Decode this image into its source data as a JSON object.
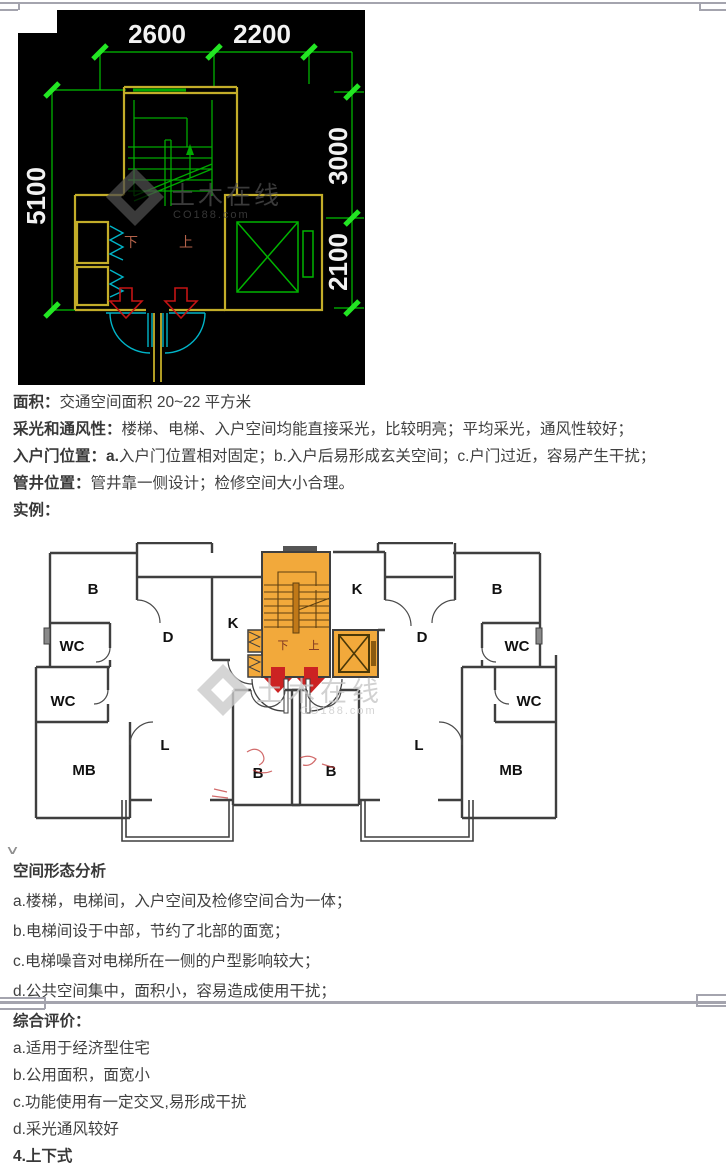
{
  "document": {
    "intro": {
      "paragraphs": [
        {
          "label": "面积：",
          "text": "交通空间面积 20~22 平方米"
        },
        {
          "label": "采光和通风性：",
          "text": "楼梯、电梯、入户空间均能直接采光，比较明亮；平均采光，通风性较好；"
        },
        {
          "label": "入户门位置：a.",
          "text": "入户门位置相对固定；b.入户后易形成玄关空间；c.户门过近，容易产生干扰；"
        },
        {
          "label": "管井位置：",
          "text": "管井靠一侧设计；检修空间大小合理。"
        },
        {
          "label": "实例：",
          "text": ""
        }
      ]
    },
    "analysis": {
      "heading": "空间形态分析",
      "items": [
        "a.楼梯，电梯间，入户空间及检修空间合为一体；",
        "b.电梯间设于中部，节约了北部的面宽；",
        "c.电梯噪音对电梯所在一侧的户型影响较大；",
        "d.公共空间集中，面积小，容易造成使用干扰；"
      ]
    },
    "evaluation": {
      "heading": "综合评价：",
      "items": [
        "a.适用于经济型住宅",
        "b.公用面积，面宽小",
        "c.功能使用有一定交叉,易形成干扰",
        "d.采光通风较好"
      ],
      "next_section": "4.上下式"
    },
    "page_mark": "∨"
  },
  "cad_drawing": {
    "dimensions": {
      "top": [
        "2600",
        "2200"
      ],
      "left": [
        "5100"
      ],
      "right": [
        "3000",
        "2100"
      ]
    },
    "stair_labels": {
      "down": "下",
      "up": "上"
    },
    "watermark": {
      "brand": "土木在线",
      "site": "CO188.com"
    },
    "colors": {
      "background": "#000000",
      "dimension_line": "#00c000",
      "tick_green": "#23e623",
      "wall_yellow": "#c3ad29",
      "stair_green": "#00a800",
      "door_cyan": "#00b4c8",
      "arrow_red": "#c41414",
      "dim_text": "#f2f2f2"
    }
  },
  "floor_plan": {
    "rooms": [
      {
        "text": "B"
      },
      {
        "text": "WC"
      },
      {
        "text": "D"
      },
      {
        "text": "K"
      },
      {
        "text": "K"
      },
      {
        "text": "B"
      },
      {
        "text": "WC"
      },
      {
        "text": "D"
      },
      {
        "text": "WC"
      },
      {
        "text": "MB"
      },
      {
        "text": "L"
      },
      {
        "text": "B"
      },
      {
        "text": "B"
      },
      {
        "text": "L"
      },
      {
        "text": "MB"
      },
      {
        "text": "WC"
      }
    ],
    "stair_labels": {
      "down": "下",
      "up": "上"
    },
    "watermark": {
      "brand": "土木在线",
      "site": "CO188.com"
    },
    "colors": {
      "highlight_orange": "#f2a93b",
      "wall": "#3f3f3f",
      "arrow_red": "#cc2222"
    }
  }
}
